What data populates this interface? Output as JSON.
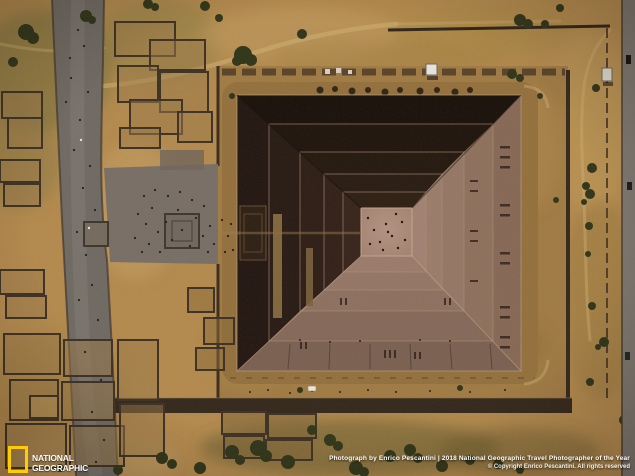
{
  "credits": {
    "line1": "Photograph by Enrico Pescantini | 2018 National Geographic Travel Photographer of the Year",
    "line2": "© Copyright Enrico Pescantini. All rights reserved"
  },
  "logo": {
    "line1": "NATIONAL",
    "line2": "GEOGRAPHIC"
  },
  "colors": {
    "ground": "#b3894c",
    "ground_dark": "#77713a",
    "enclosure": "#a07a42",
    "platform": "#936f3b",
    "road": "#6e6861",
    "plaza": "#776d64",
    "wall": "#33261a",
    "ruins": "#3c2f22",
    "tree": "#2f3316",
    "path": "#cfae6f",
    "pyramid_shadow_north": "#190f09",
    "pyramid_shadow_west": "#221510",
    "pyramid_lit_south": "#8d6f5e",
    "pyramid_lit_east": "#947663",
    "apex": "#a98875",
    "logo_yellow": "#ffcc00",
    "text_white": "#ffffff"
  }
}
